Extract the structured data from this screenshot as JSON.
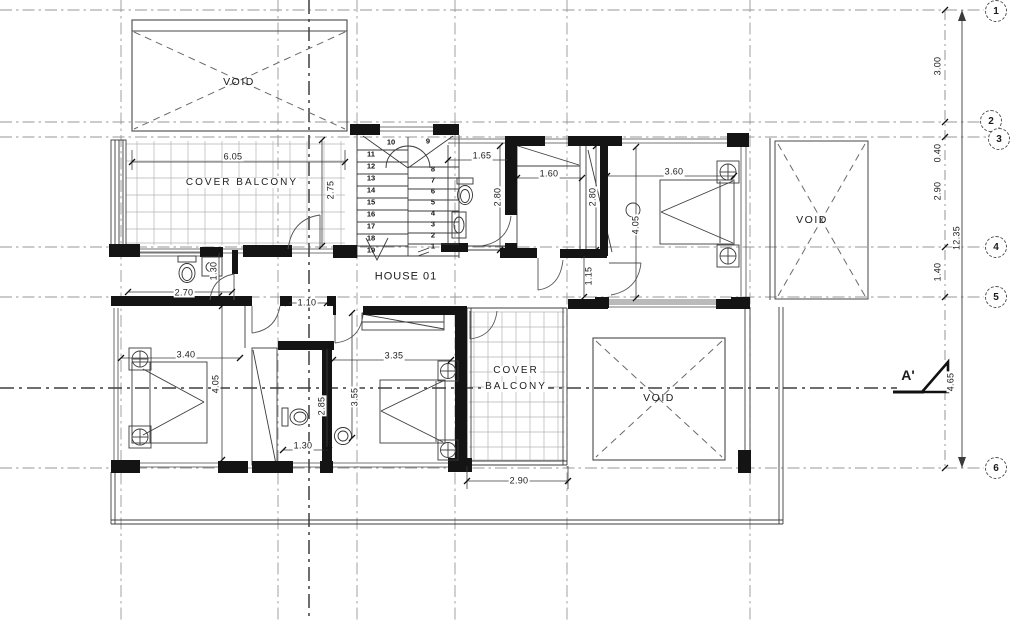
{
  "labels": {
    "house": "HOUSE 01",
    "void_top_left": "VOID",
    "void_top_right": "VOID",
    "void_bottom_right": "VOID",
    "balcony_top": "COVER BALCONY",
    "balcony_bottom_line1": "COVER",
    "balcony_bottom_line2": "BALCONY",
    "section_marker": "A'"
  },
  "grid": {
    "bubbles": [
      "1",
      "2",
      "3",
      "4",
      "5",
      "6"
    ]
  },
  "dimensions": {
    "right_chain": [
      "3.00",
      "0.40",
      "2.90",
      "1.40",
      "4.65"
    ],
    "right_total": "12.35",
    "balcony_top_width": "6.05",
    "balcony_top_depth": "2.75",
    "bath_top_width": "1.65",
    "bath_top_depth": "2.80",
    "wardrobe_width": "1.60",
    "wardrobe_depth": "2.80",
    "bedroom1_width": "3.60",
    "bedroom1_depth": "4.05",
    "hall_niche": "1.15",
    "bath_left_width": "2.70",
    "bath_left_depth": "1.30",
    "hall_width": "1.10",
    "bedroom2_width": "3.40",
    "bedroom2_depth": "4.05",
    "bedroom3_width": "3.35",
    "bedroom3_depth": "3.55",
    "bath_mid_depth": "2.85",
    "bath_mid_width": "1.30",
    "balcony_bottom_width": "2.90"
  },
  "stairs": {
    "left_flight": [
      "11",
      "12",
      "13",
      "14",
      "15",
      "16",
      "17",
      "18",
      "19"
    ],
    "top_row": [
      "10",
      "9"
    ],
    "right_flight": [
      "8",
      "7",
      "6",
      "5",
      "4",
      "3",
      "2",
      "1"
    ]
  }
}
